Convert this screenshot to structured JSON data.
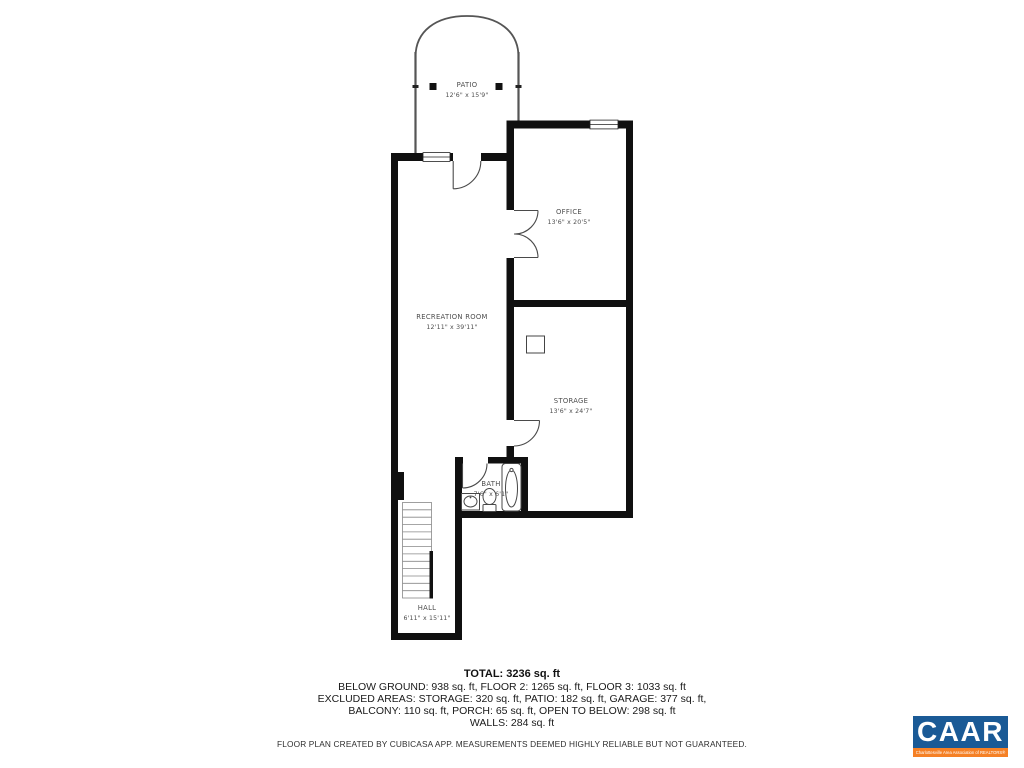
{
  "floor_plan": {
    "rooms": [
      {
        "id": "patio",
        "name": "PATIO",
        "dims": "12'6\" x 15'9\""
      },
      {
        "id": "office",
        "name": "OFFICE",
        "dims": "13'6\" x 20'5\""
      },
      {
        "id": "recreation-room",
        "name": "RECREATION ROOM",
        "dims": "12'11\" x 39'11\""
      },
      {
        "id": "storage",
        "name": "STORAGE",
        "dims": "13'6\" x 24'7\""
      },
      {
        "id": "bath",
        "name": "BATH",
        "dims": "7'6\" x 6'1\""
      },
      {
        "id": "hall",
        "name": "HALL",
        "dims": "6'11\" x 15'11\""
      }
    ],
    "wall_color": "#101010"
  },
  "summary": {
    "total": "TOTAL: 3236 sq. ft",
    "floors": "BELOW GROUND: 938 sq. ft, FLOOR 2: 1265 sq. ft, FLOOR 3: 1033 sq. ft",
    "excluded_1": "EXCLUDED AREAS: STORAGE: 320 sq. ft, PATIO: 182 sq. ft, GARAGE: 377 sq. ft,",
    "excluded_2": "BALCONY: 110 sq. ft, PORCH: 65 sq. ft, OPEN TO BELOW: 298 sq. ft",
    "walls": "WALLS: 284 sq. ft"
  },
  "disclaimer": "FLOOR PLAN CREATED BY CUBICASA APP. MEASUREMENTS DEEMED HIGHLY RELIABLE BUT NOT GUARANTEED.",
  "logo": {
    "name": "CAAR",
    "tagline": "Charlottesville Area Association of REALTORS®",
    "colors": {
      "blue": "#1a5a96",
      "orange": "#f58025"
    }
  }
}
